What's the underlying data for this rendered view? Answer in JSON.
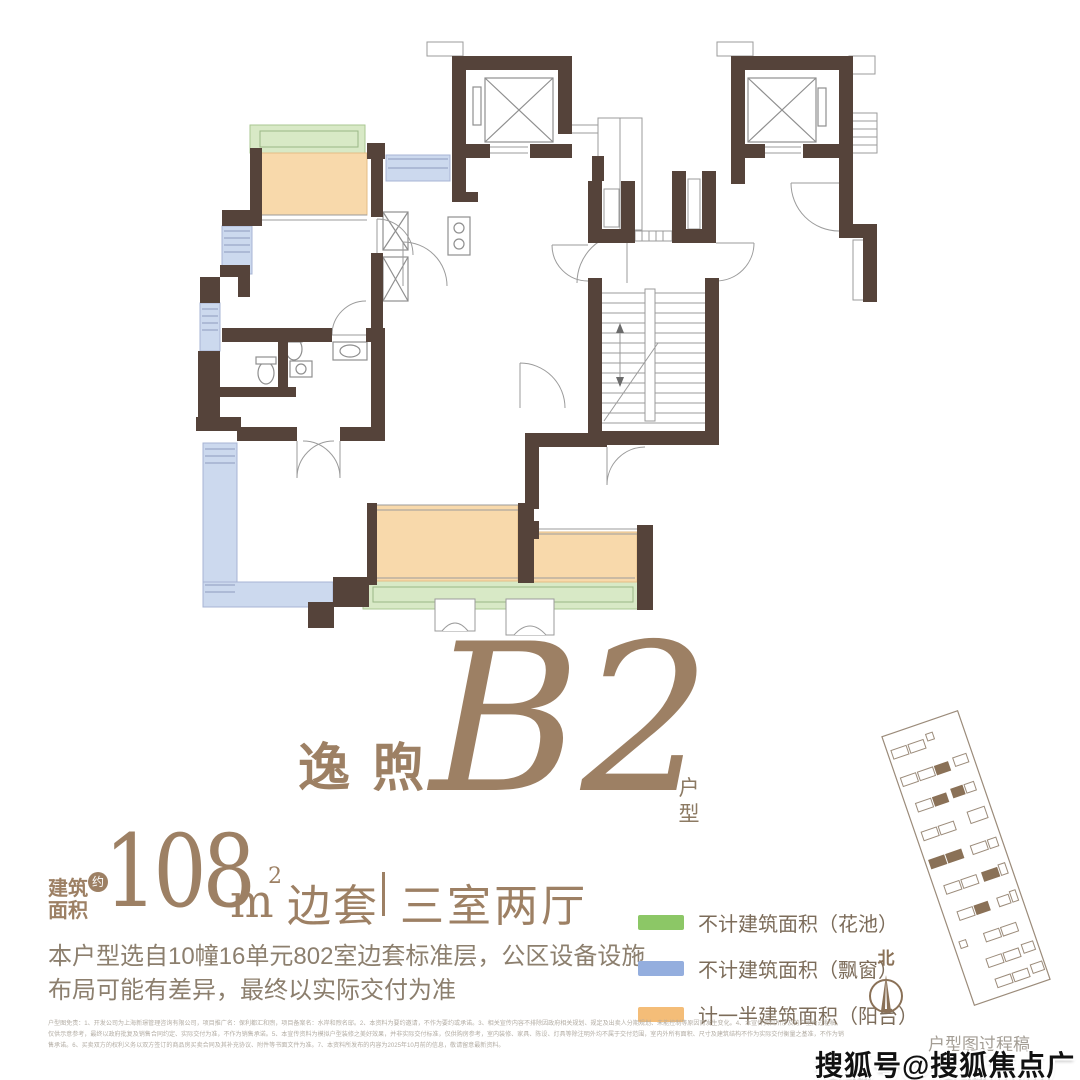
{
  "title": {
    "brand": "逸煦",
    "model": "B2",
    "suffix_chars": [
      "户",
      "型"
    ]
  },
  "area": {
    "label1": "建筑",
    "label2": "面积",
    "approx": "约",
    "value": "108",
    "unit_base": "m",
    "unit_sup": "2",
    "tag": "边套",
    "layout": "三室两厅"
  },
  "description": [
    "本户型选自10幢16单元802室边套标准层，公区设备设施",
    "布局可能有差异，最终以实际交付为准"
  ],
  "legend": {
    "items": [
      {
        "name": "flower-pool",
        "color": "#8cc766",
        "label": "不计建筑面积（花池）"
      },
      {
        "name": "bay-window",
        "color": "#94aede",
        "label": "不计建筑面积（飘窗）"
      },
      {
        "name": "balcony",
        "color": "#f4bd78",
        "label": "计一半建筑面积（阳台）"
      }
    ]
  },
  "compass": {
    "north_label": "北"
  },
  "plan_note": "户型图过程稿",
  "watermark": "搜狐号@搜狐焦点广安站",
  "disclaimer": [
    "户型图免责：1、开发公司为上海新璟管理咨询有限公司，项目推广名：保利都汇和煦，项目备案名：水岸和煦名邸。2、本资料为要约邀请，不作为要约或承诺。3、相关宣传内容不排除因政府相关规划、规定及出卖人分期规划、未能控制等原因而发生变化。4、本宣传资料所涉及的户型为过程稿，",
    "仅供示意参考，最终以政府批复及销售合同约定、实际交付为准，不作为销售承诺。5、本宣传资料为模拟户型装修之美好效果，并非实际交付标准，仅供购房参考，室内装修、家具、陈设、灯具等除注明外均不属于交付范围，室内外所有面积、尺寸及建筑结构不作为实际交付衡量之基准，不作为销",
    "售承诺。6、买卖双方的权利义务以双方签订的商品房买卖合同及其补充协议、附件等书面文件为准。7、本资料所发布的内容为2025年10月前的信息，敬请留意最新资料。"
  ],
  "colors": {
    "accent_taupe": "#9d8064",
    "wall_brown": "#55433a",
    "text_brown": "#8c7f6e",
    "plan_green": "#d8e9c6",
    "plan_blue": "#ccd9ee",
    "plan_orange": "#f8d9ab"
  }
}
